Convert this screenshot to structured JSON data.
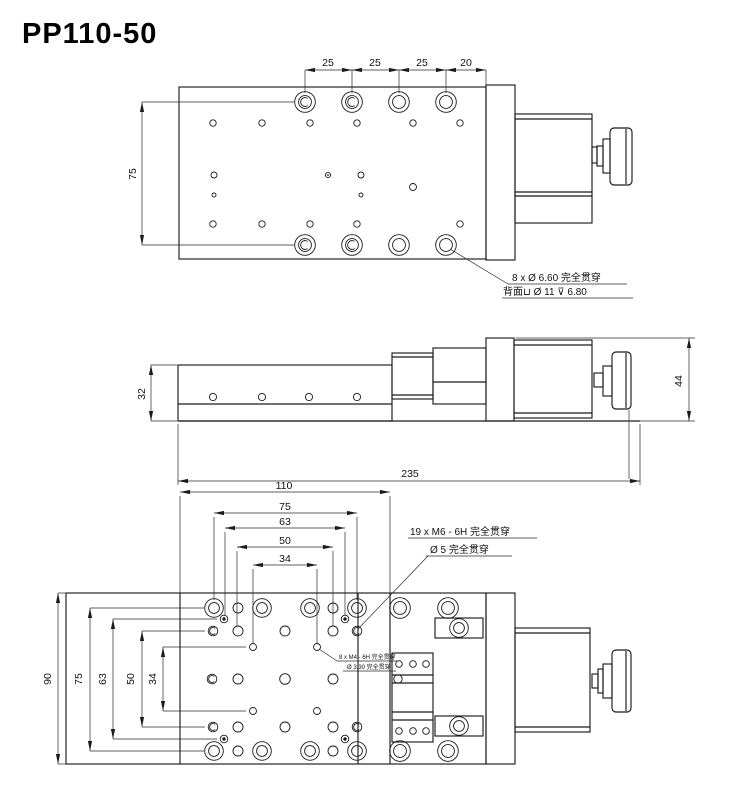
{
  "title": "PP110-50",
  "top_view": {
    "dim_25a": "25",
    "dim_25b": "25",
    "dim_25c": "25",
    "dim_20": "20",
    "dim_75": "75",
    "callout_l1": "8 x Ø 6.60 完全贯穿",
    "callout_l2": "背面⊔ Ø 11 ⊽ 6.80"
  },
  "side_view": {
    "dim_32": "32",
    "dim_44": "44",
    "dim_235": "235"
  },
  "bottom_view": {
    "dim_110": "110",
    "dim_75": "75",
    "dim_63": "63",
    "dim_50": "50",
    "dim_34": "34",
    "dim_v90": "90",
    "dim_v75": "75",
    "dim_v63": "63",
    "dim_v50": "50",
    "dim_v34": "34",
    "callout_m6_l1": "19 x M6 - 6H 完全贯穿",
    "callout_m6_l2": "Ø 5 完全贯穿",
    "callout_m4_l1": "8 x M4 - 6H 完全贯穿",
    "callout_m4_l2": "Ø 3.30 完全贯穿"
  }
}
